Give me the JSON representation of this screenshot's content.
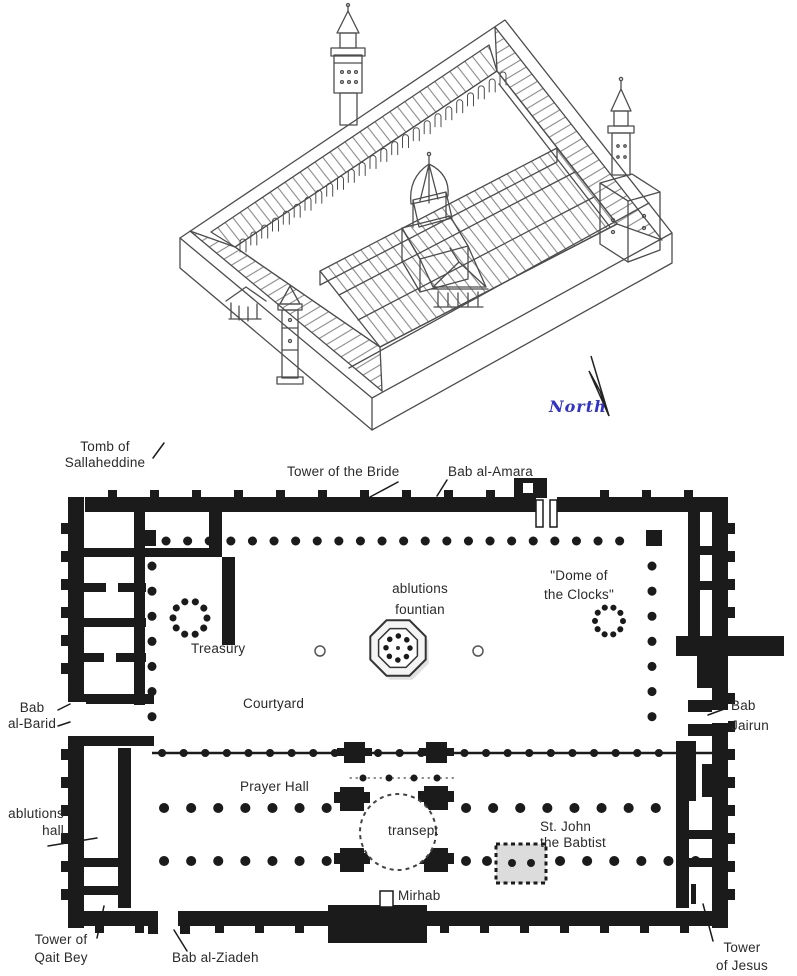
{
  "canvas": {
    "width": 797,
    "height": 976
  },
  "colors": {
    "wall_black": "#1b1b1b",
    "line_art_gray": "#4d4d4d",
    "hatch_gray": "#8a8a8a",
    "label_text": "#2a2a2a",
    "north_blue": "#3232c8"
  },
  "north_indicator": {
    "label": "North"
  },
  "plan_labels": {
    "tomb_of_sallaheddine": {
      "lines": [
        "Tomb of",
        "Sallaheddine"
      ]
    },
    "tower_of_the_bride": {
      "text": "Tower of the Bride"
    },
    "bab_al_amara": {
      "text": "Bab al-Amara"
    },
    "ablutions_fountain": {
      "lines": [
        "ablutions",
        "fountian"
      ]
    },
    "dome_of_the_clocks": {
      "lines": [
        "\"Dome of",
        "the Clocks\""
      ]
    },
    "treasury": {
      "text": "Treasury"
    },
    "courtyard": {
      "text": "Courtyard"
    },
    "bab_al_barid": {
      "lines": [
        "Bab",
        "al-Barid"
      ]
    },
    "bab_jairun": {
      "lines": [
        "Bab",
        "Jairun"
      ]
    },
    "prayer_hall": {
      "text": "Prayer Hall"
    },
    "transept": {
      "text": "transept"
    },
    "st_john_the_baptist": {
      "lines": [
        "St. John",
        "the Babtist"
      ]
    },
    "ablutions_hall": {
      "lines": [
        "ablutions",
        "hall"
      ]
    },
    "mihrab": {
      "text": "Mirhab"
    },
    "tower_of_qait_bey": {
      "lines": [
        "Tower of",
        "Qait Bey"
      ]
    },
    "bab_al_ziadeh": {
      "text": "Bab al-Ziadeh"
    },
    "tower_of_jesus": {
      "lines": [
        "Tower",
        "of Jesus"
      ]
    }
  }
}
